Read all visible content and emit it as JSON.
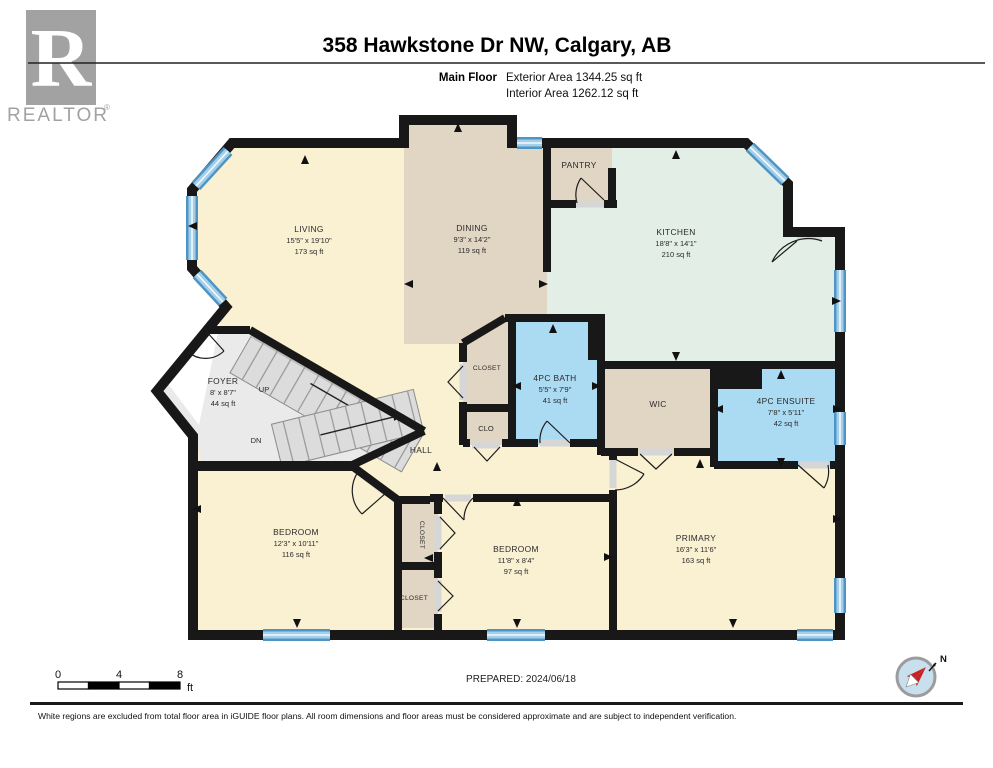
{
  "header": {
    "title": "358 Hawkstone Dr NW, Calgary, AB",
    "floor_label": "Main Floor",
    "exterior_area": "Exterior Area 1344.25 sq ft",
    "interior_area": "Interior Area 1262.12 sq ft",
    "logo_letter": "R",
    "logo_word": "REALTOR",
    "logo_reg": "®"
  },
  "rooms": {
    "living": {
      "name": "LIVING",
      "dims": "15'5\" x 19'10\"",
      "area": "173 sq ft"
    },
    "dining": {
      "name": "DINING",
      "dims": "9'3\" x 14'2\"",
      "area": "119 sq ft"
    },
    "kitchen": {
      "name": "KITCHEN",
      "dims": "18'8\" x 14'1\"",
      "area": "210 sq ft"
    },
    "pantry": {
      "name": "PANTRY"
    },
    "foyer": {
      "name": "FOYER",
      "dims": "8' x 8'7\"",
      "area": "44 sq ft"
    },
    "hall": {
      "name": "HALL"
    },
    "bath": {
      "name": "4PC BATH",
      "dims": "5'5\" x 7'9\"",
      "area": "41 sq ft"
    },
    "wic": {
      "name": "WIC"
    },
    "ensuite": {
      "name": "4PC ENSUITE",
      "dims": "7'8\" x 5'11\"",
      "area": "42 sq ft"
    },
    "bedroom1": {
      "name": "BEDROOM",
      "dims": "12'3\" x 10'11\"",
      "area": "116 sq ft"
    },
    "bedroom2": {
      "name": "BEDROOM",
      "dims": "11'8\" x 8'4\"",
      "area": "97 sq ft"
    },
    "primary": {
      "name": "PRIMARY",
      "dims": "16'3\" x 11'6\"",
      "area": "163 sq ft"
    },
    "closet_hall": {
      "name": "CLOSET"
    },
    "clo": {
      "name": "CLO"
    },
    "closet_bed1": {
      "name": "CLOSET"
    },
    "closet_bed1b": {
      "name": "CLOSET"
    },
    "up": "UP",
    "dn": "DN"
  },
  "footer": {
    "scale": {
      "t0": "0",
      "t4": "4",
      "t8": "8",
      "unit": "ft"
    },
    "prepared": "PREPARED: 2024/06/18",
    "north_label": "N",
    "disclaimer": "White regions are excluded from total floor area in iGUIDE floor plans. All room dimensions and floor areas must be considered approximate and are subject to independent verification."
  },
  "colors": {
    "cream": "#faf1d3",
    "beige": "#e1d6c3",
    "mint": "#e2eee6",
    "blue": "#abdaf3",
    "gray": "#eaeaea",
    "stair": "#dcdcdc",
    "wall": "#181818",
    "window": "#4e95c6",
    "logo_gray": "#a2a2a2",
    "compass_red": "#cc1f1f",
    "compass_face": "#c8dfed"
  }
}
